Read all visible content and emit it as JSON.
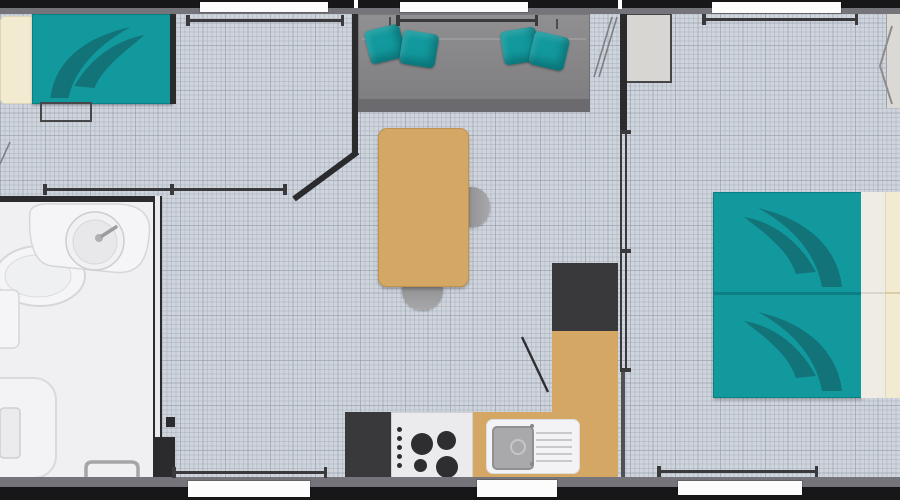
{
  "title": "mobile-home floor plan (top-down view, no visible text)",
  "colors": {
    "floor": "#d0d5dd",
    "floor-grid": "rgba(160,170,183,0.45)",
    "floor-grid-strong": "rgba(140,150,165,0.38)",
    "bath-floor": "#f0f0f2",
    "wall-black": "#17171a",
    "wall-gray": "#74747a",
    "wall-dark": "#2b2b2d",
    "rail": "#3a3a3d",
    "window-white": "#fcfcfc",
    "teal": "#12999d",
    "teal-dark": "#136f76",
    "bed-divider": "#0d7f84",
    "wood": "#d4a765",
    "wood-border": "#c09250",
    "sofa": "#87878a",
    "sofa-dark": "#6b6b6f",
    "appliance-dark": "#39393c",
    "burner": "#2e2e31",
    "cream": "#f2ebd1",
    "bed-white": "#efece6",
    "white-fixture": "#f5f5f7",
    "fixture-line": "#d6d6d8",
    "steel": "#a9a9ab",
    "chair": "#a0a0a3",
    "wardrobe": "#d8d6d2",
    "door-line": "#7f7f82"
  },
  "legend": {
    "rooms": [
      "left-bedroom",
      "entry-hall",
      "bathroom",
      "living-kitchen",
      "right-bedroom"
    ],
    "furniture": [
      "single-bed",
      "bench",
      "vanity-washbasin",
      "toilet",
      "shower-tray",
      "sofa-with-4-cushions",
      "dining-table",
      "two-chairs",
      "fridge",
      "gas-hob-4-burners",
      "sink-with-drainboard",
      "l-shaped-counter",
      "overhead-unit",
      "wardrobe",
      "double-bed-with-pillows"
    ]
  }
}
